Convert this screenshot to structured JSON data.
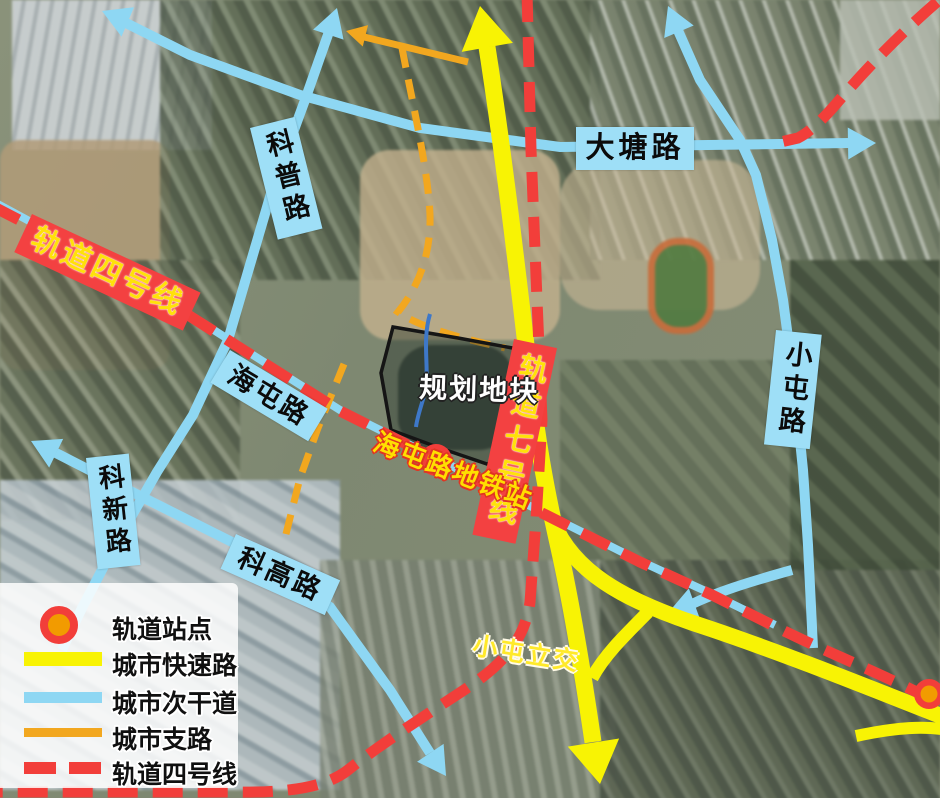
{
  "labels": {
    "kepu": "科普路",
    "datang": "大塘路",
    "haitun": "海屯路",
    "xiaotun_road": "小屯路",
    "kexin": "科新路",
    "kegao": "科高路",
    "line4_banner": "轨道四号线",
    "line7_banner": "轨道七号线",
    "metro_station": "海屯路地铁站",
    "interchange": "小屯立交",
    "plot": "规划地块"
  },
  "legend": {
    "items": [
      {
        "symbol": "station-circle",
        "label": "轨道站点"
      },
      {
        "symbol": "expressway-line",
        "label": "城市快速路"
      },
      {
        "symbol": "secondary-road-line",
        "label": "城市次干道"
      },
      {
        "symbol": "branch-road-line",
        "label": "城市支路"
      },
      {
        "symbol": "rail-line4-dash",
        "label": "轨道四号线"
      }
    ]
  },
  "colors": {
    "expressway": "#f8f304",
    "secondary_road": "#8ed7f3",
    "branch_road": "#f2a71f",
    "rail_line": "#f23e3a",
    "station_fill": "#f29b00",
    "banner_bg": "#f34141",
    "banner_text": "#ffe10a",
    "road_label_bg": "#9edff7"
  }
}
